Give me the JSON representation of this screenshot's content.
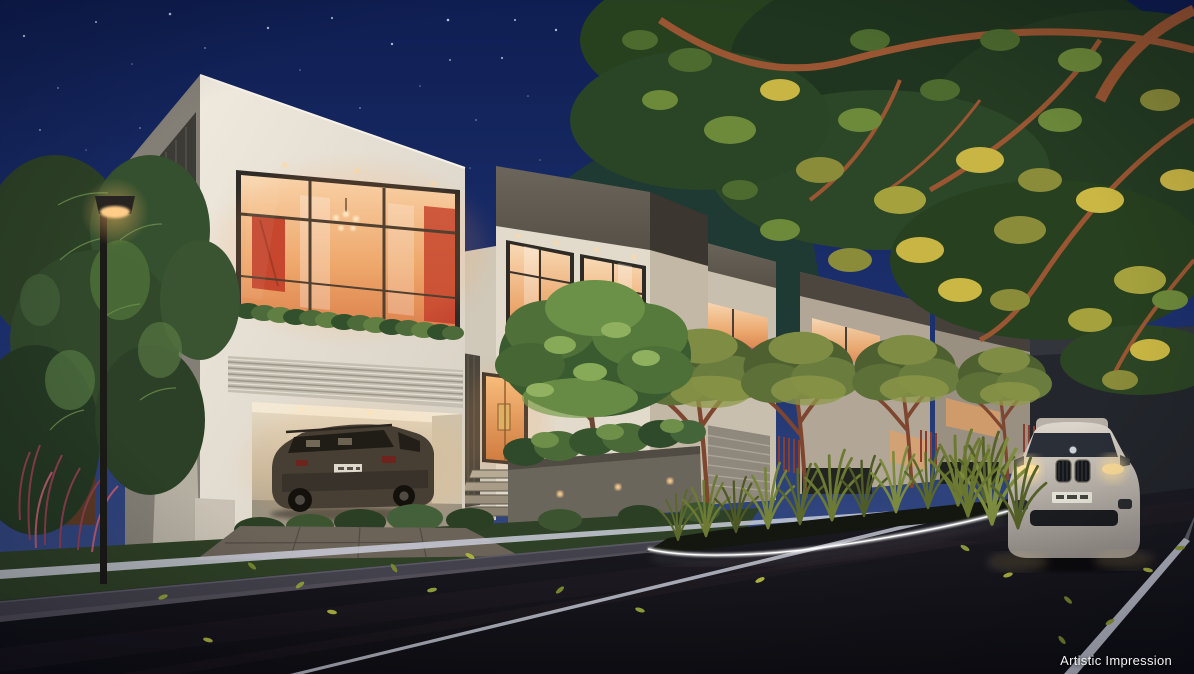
{
  "caption": {
    "text": "Artistic Impression"
  },
  "scene": {
    "type": "architectural-night-render",
    "elements": [
      "night-sky-with-stars",
      "hill-silhouette",
      "modern-two-storey-villas",
      "lit-interior-window-with-red-artwork-and-chandelier",
      "open-garage-with-brown-suv",
      "lit-entrance-door-with-steps",
      "courtyard-tree-in-planter-with-uplights",
      "row-of-villas-with-balcony-flowers",
      "street-lamp",
      "overhanging-tree-canopy-uplit",
      "median-planter-with-ornamental-grasses",
      "led-strip-kerb-lighting",
      "white-suv-with-headlights-on",
      "asphalt-road-with-lane-markings",
      "fallen-leaves"
    ]
  },
  "palette": {
    "sky_top": "#0f1e52",
    "sky_mid": "#1d3170",
    "sky_horizon": "#41558a",
    "hill_green": "#203a30",
    "wall_light": "#efe9de",
    "wall_mid": "#d6cfc2",
    "wall_shadow": "#847f76",
    "fascia_dark": "#565047",
    "window_warm": "#f8d9b4",
    "window_deep": "#d97f4e",
    "accent_red": "#bf3b2a",
    "foliage_dark": "#27411f",
    "foliage_mid": "#4d6b35",
    "foliage_light": "#7c9a4e",
    "foliage_yellow": "#c9b544",
    "branch_brown": "#9a5632",
    "grass_verge": "#2e4026",
    "road_top": "#1d1c24",
    "road_bottom": "#0e0e13",
    "lane_line": "#c9cdd8",
    "led_white": "#ffffff",
    "lamp_glow": "#ffb763",
    "garage_warm": "#e8dcc6",
    "suv_brown": "#473f33",
    "car_white": "#ddd6cc",
    "headlight_glow": "#ffdf9b",
    "flower_pink": "#b95f7d",
    "soil_dark": "#14170f",
    "concrete_grey": "#514e58",
    "corten_rust": "#5c3a26",
    "caption_color": "#f2f2f2"
  }
}
